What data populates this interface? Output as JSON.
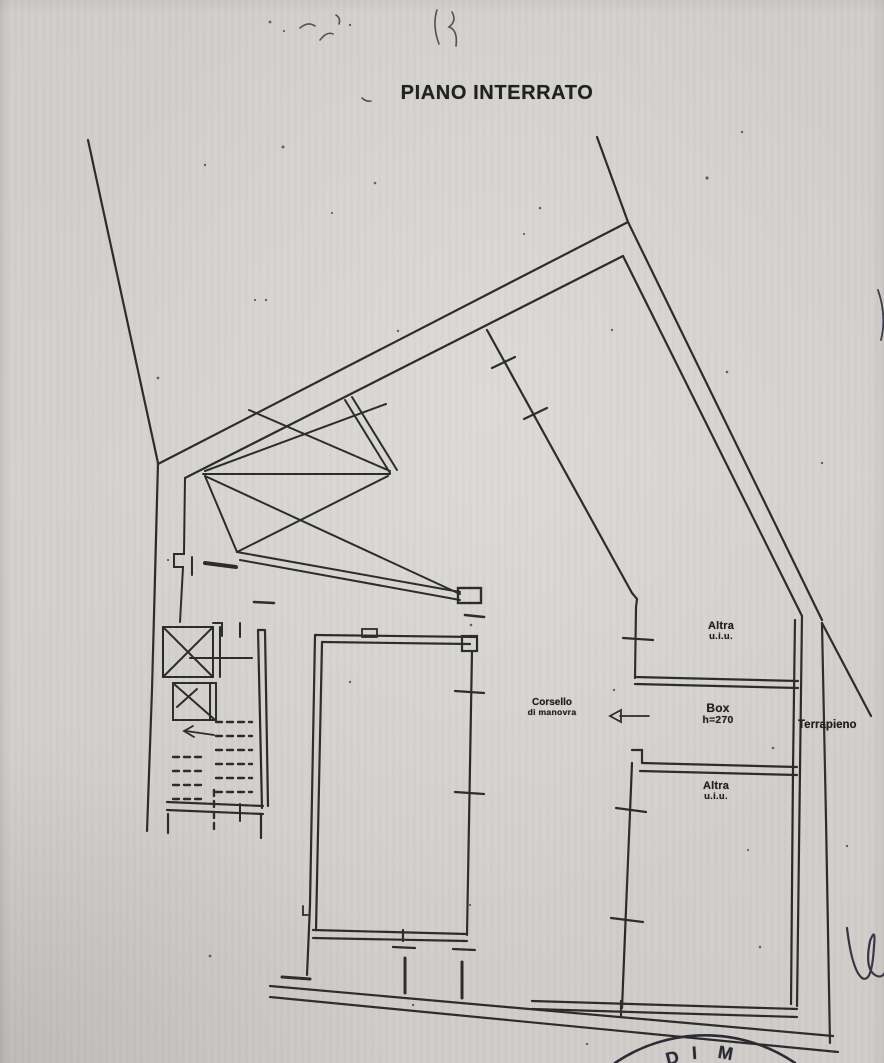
{
  "document": {
    "title": "PIANO INTERRATO"
  },
  "labels": {
    "altra_top": {
      "line1": "Altra",
      "line2": "u.i.u."
    },
    "box": {
      "line1": "Box",
      "line2": "h=270"
    },
    "altra_bottom": {
      "line1": "Altra",
      "line2": "u.i.u."
    },
    "corsello": {
      "line1": "Corsello",
      "line2": "di manovra"
    },
    "terrapieno": "Terrapieno"
  },
  "stamp": {
    "visible_text": "DI M",
    "letters": [
      "D",
      "I",
      "M"
    ]
  },
  "colors": {
    "paper": "#d2d0cd",
    "ink": "#2b2b2b",
    "pen": "#22222e",
    "stamp_ink": "#2a2a33"
  }
}
